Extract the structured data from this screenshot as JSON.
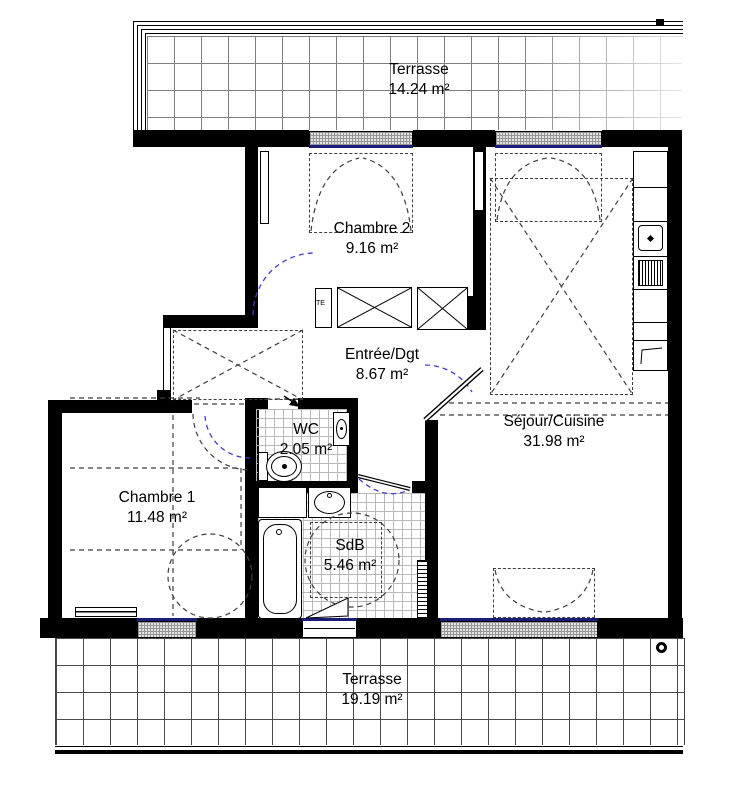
{
  "rooms": {
    "terrace_top": {
      "name": "Terrasse",
      "area": "14.24 m²"
    },
    "chambre2": {
      "name": "Chambre 2",
      "area": "9.16 m²"
    },
    "entree": {
      "name": "Entrée/Dgt",
      "area": "8.67 m²"
    },
    "wc": {
      "name": "WC",
      "area": "2.05 m²"
    },
    "chambre1": {
      "name": "Chambre 1",
      "area": "11.48 m²"
    },
    "sejour": {
      "name": "Séjour/Cuisine",
      "area": "31.98 m²"
    },
    "sdb": {
      "name": "SdB",
      "area": "5.46 m²"
    },
    "terrace_bottom": {
      "name": "Terrasse",
      "area": "19.19 m²"
    }
  },
  "annotations": {
    "electrical_panel": "TE"
  },
  "colors": {
    "wall": "#000000",
    "door_swing_blue": "#4040cc",
    "window_glazing": "#1b1b78",
    "dashed_line": "#3f3f3f",
    "terrace_tile_line": "#7e7e7e"
  }
}
